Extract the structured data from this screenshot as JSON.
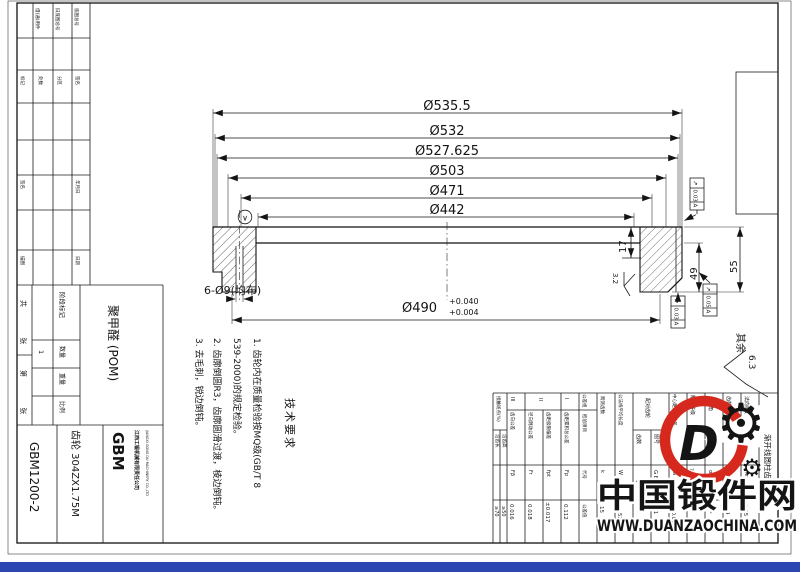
{
  "colors": {
    "bar_blue": "#2b46b0",
    "watermark_red": "#d6281c",
    "watermark_blue": "#3a87d4",
    "watermark_blue_dark": "#1f5fb8"
  },
  "dims": {
    "diameters": [
      "Ø535.5",
      "Ø532",
      "Ø527.625",
      "Ø503",
      "Ø471",
      "Ø442"
    ],
    "bore_value": "Ø490",
    "bore_tol_upper": "+0.040",
    "bore_tol_lower": "+0.004",
    "holes_note": "6-Ø9(均布)",
    "web_thickness": "17",
    "rim_width": "49",
    "total_width": "55",
    "datum_glyph": "∨"
  },
  "geo_tolerances": [
    {
      "sym": "↗",
      "val": "0.03",
      "datum": "A"
    },
    {
      "sym": "↗",
      "val": "0.03",
      "datum": "A"
    },
    {
      "sym": "↗",
      "val": "0.05",
      "datum": "A"
    }
  ],
  "roughness": {
    "local": "3.2",
    "general_label": "其余",
    "general_value": "6.3"
  },
  "tech_req": {
    "title": "技术要求",
    "lines": [
      "1. 齿轮内在质量检验按MQ级(GB/T 8",
      "539-2000)的规定检验。",
      "2. 齿廓倒圆R3，齿廓圆滑过渡，棱边倒钝。",
      "3. 去毛刺，锐边倒钝。"
    ]
  },
  "title_block": {
    "material": "聚甲醛 (POM)",
    "part_name": "齿轮 304ZX1.75M",
    "drawing_no": "GBM1200-2",
    "logo": "GBM",
    "company_cn": "江西工锻机械有限责任公司",
    "company_en": "JIANGXI GONG DU MACHINERY CO.,LTD",
    "stage_label": "阶段标记",
    "qty_label": "数量",
    "qty_value": "1",
    "weight_label": "重量",
    "scale_label": "比例",
    "sheets_total": "共 张",
    "sheet_no": "第 张",
    "small_labels": [
      "借(通)用件",
      "旧底图总号",
      "底图总号",
      "标记",
      "处数",
      "分区",
      "签名",
      "年月日",
      "签名",
      "年月日",
      "描图",
      "日期"
    ]
  },
  "gear_table": {
    "title": "渐开线圆柱齿轮参数",
    "rows": {
      "module": {
        "label": "法向模数",
        "sym": "mn",
        "val": "1.75"
      },
      "teeth": {
        "label": "齿数",
        "sym": "z",
        "val": "304"
      },
      "angle": {
        "label": "齿形角",
        "sym": "α",
        "val": "20°"
      },
      "grade": {
        "label": "精度等级",
        "val": "7 GB/T 10095.1"
      },
      "center": {
        "label": "中心距及其偏差",
        "sym": "a",
        "val": "399±0.04"
      },
      "mate": {
        "label": "配对齿轮",
        "no_label": "图号",
        "no": "GBM1200-1",
        "z_label": "齿数",
        "z": "152"
      },
      "wk": {
        "label": "公法线平均长度",
        "sym": "W",
        "val": "100.5282"
      },
      "span": {
        "label": "跨测齿数",
        "sym": "k",
        "val": "15"
      },
      "header": {
        "group": "公差组",
        "item": "检验项目",
        "sym": "代号",
        "tol": "公差值"
      },
      "g1": {
        "mark": "I",
        "label": "齿距累积总公差",
        "sym": "Fp",
        "val": "0.112"
      },
      "g2a": {
        "mark": "II",
        "label": "齿距极限偏差",
        "sym": "fpt",
        "val": "±0.017"
      },
      "g2b": {
        "label": "径向跳动公差",
        "sym": "Fr",
        "val": "0.018"
      },
      "g3": {
        "mark": "III",
        "label": "齿向公差",
        "sym": "Fβ",
        "val": "0.016"
      },
      "contact": {
        "label": "接触斑点(%)",
        "h_label": "沿齿高",
        "h_val": "≥50",
        "l_label": "沿齿长",
        "l_val": "≥70"
      }
    }
  },
  "watermark": {
    "site_name": "中国锻件网",
    "site_url": "WWW.DUANZAOCHINA.COM",
    "logo_letter": "D"
  }
}
